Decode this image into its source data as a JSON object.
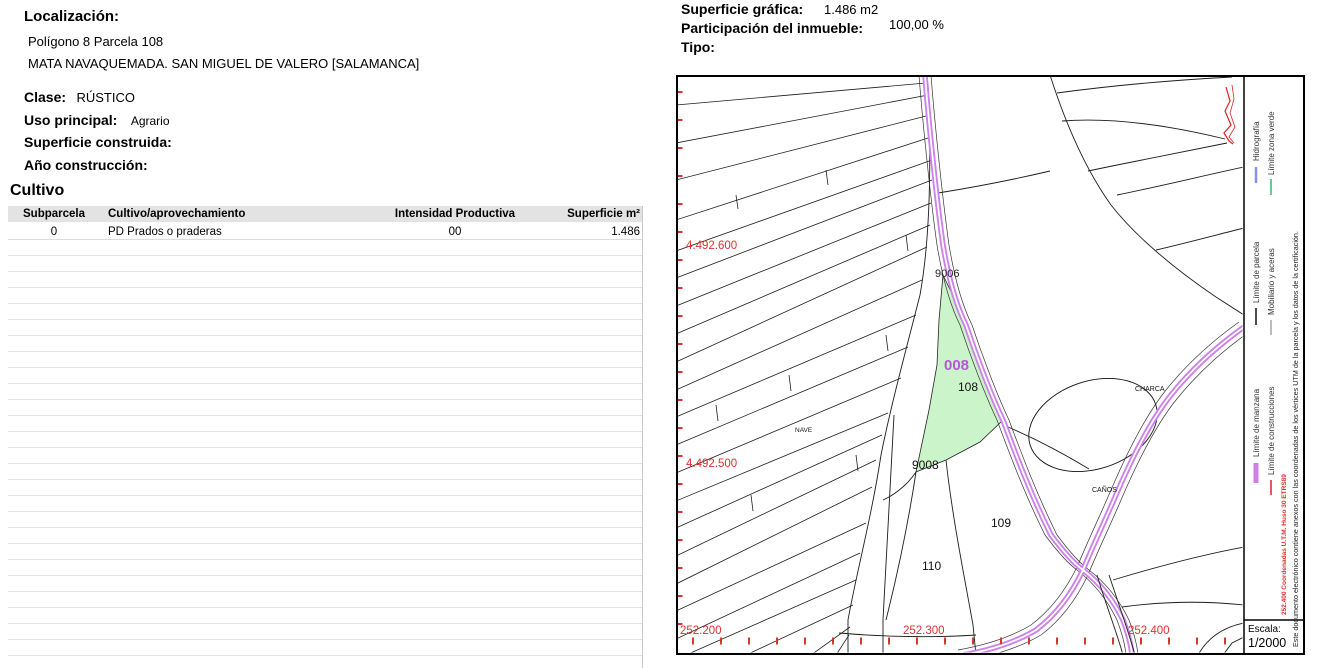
{
  "left_panel": {
    "localizacion_label": "Localización:",
    "localizacion_line1": "Polígono 8 Parcela 108",
    "localizacion_line2": "MATA NAVAQUEMADA. SAN MIGUEL DE VALERO [SALAMANCA]",
    "clase_label": "Clase:",
    "clase_value": "RÚSTICO",
    "uso_label": "Uso principal:",
    "uso_value": "Agrario",
    "superficie_construida_label": "Superficie construida:",
    "ano_construccion_label": "Año construcción:",
    "cultivo_title": "Cultivo",
    "table": {
      "headers": [
        "Subparcela",
        "Cultivo/aprovechamiento",
        "Intensidad Productiva",
        "Superficie m²"
      ],
      "rows": [
        [
          "0",
          "PD Prados o praderas",
          "00",
          "1.486"
        ]
      ],
      "empty_row_count": 27
    }
  },
  "right_panel": {
    "superficie_grafica_label": "Superficie gráfica:",
    "superficie_grafica_value": "1.486 m2",
    "participacion_label": "Participación del inmueble:",
    "participacion_value": "100,00 %",
    "tipo_label": "Tipo:"
  },
  "map": {
    "labels": {
      "p9006": "9006",
      "p008": "008",
      "p108": "108",
      "p9008": "9008",
      "nave": "NAVE",
      "charca": "CHARCA",
      "canos": "CAÑOS",
      "p109": "109",
      "p110": "110"
    },
    "coords": {
      "y1": "4.492.600",
      "y2": "4.492.500",
      "x1": "252.200",
      "x2": "252.300",
      "x3": "252.400"
    },
    "legend": {
      "limite_manzana": "Límite de manzana",
      "limite_parcela": "Límite de parcela",
      "hidrografia": "Hidrografía",
      "limite_construcciones": "Límite de construcciones",
      "mobiliario": "Mobiliario y aceras",
      "limite_zona_verde": "Límite zona verde",
      "coordenadas": "252.400 Coordenadas U.T.M. Huso 30 ETRS89",
      "disclaimer": "Este documento electrónico contiene anexos con las coordenadas de los vértices UTM de la parcela y los datos de la certificación."
    },
    "escala_label": "Escala:",
    "escala_value": "1/2000",
    "colors": {
      "parcel_highlight": "#ccf4ca",
      "road": "#cd80ea",
      "label_008": "#b459d6",
      "coord_red": "#e03030",
      "construction_red": "#dd2222",
      "zona_verde_green": "#66cc88",
      "hidrografia_blue": "#8d8dee",
      "mobiliario_gray": "#bbbbbb"
    }
  }
}
